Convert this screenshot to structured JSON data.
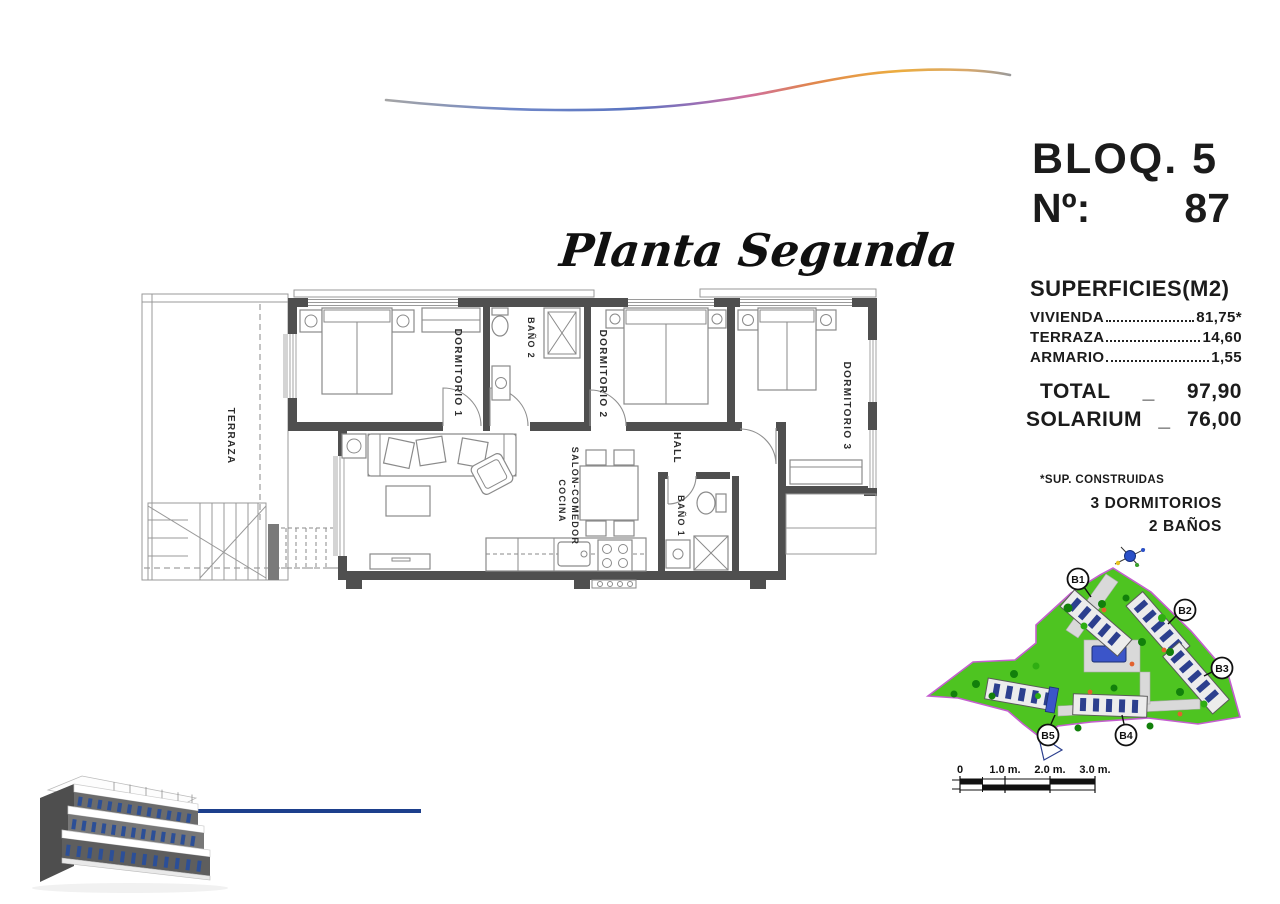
{
  "header": {
    "block_label": "BLOQ. 5",
    "number_label": "Nº:",
    "number_value": "87",
    "plan_title": "Planta Segunda"
  },
  "floorplan": {
    "rooms": [
      "TERRAZA",
      "DORMITORIO 1",
      "BAÑO 2",
      "DORMITORIO 2",
      "DORMITORIO 3",
      "HALL",
      "SALON-COMEDOR",
      "COCINA",
      "BAÑO 1"
    ]
  },
  "surfaces": {
    "title": "SUPERFICIES(M2)",
    "items": [
      {
        "label": "VIVIENDA",
        "value": "81,75*"
      },
      {
        "label": "TERRAZA",
        "value": "14,60"
      },
      {
        "label": "ARMARIO",
        "value": "1,55"
      }
    ],
    "totals": [
      {
        "label": "TOTAL",
        "sep": "_",
        "value": "97,90"
      },
      {
        "label": "SOLARIUM",
        "sep": "_",
        "value": "76,00"
      }
    ],
    "footnote": "*SUP. CONSTRUIDAS",
    "features": [
      "3 DORMITORIOS",
      "2 BAÑOS"
    ]
  },
  "siteplan": {
    "block_labels": [
      "B1",
      "B2",
      "B3",
      "B4",
      "B5"
    ],
    "colors": {
      "ground_green": "#4ec421",
      "boundary_magenta": "#c45ecf",
      "pool_blue": "#3b55c9",
      "building_navy": "#2c3f8e"
    }
  },
  "scalebar": {
    "ticks": [
      "0",
      "1.0 m.",
      "2.0 m.",
      "3.0 m."
    ]
  },
  "branding": {
    "accent_line_navy": "#1d3f8c"
  }
}
